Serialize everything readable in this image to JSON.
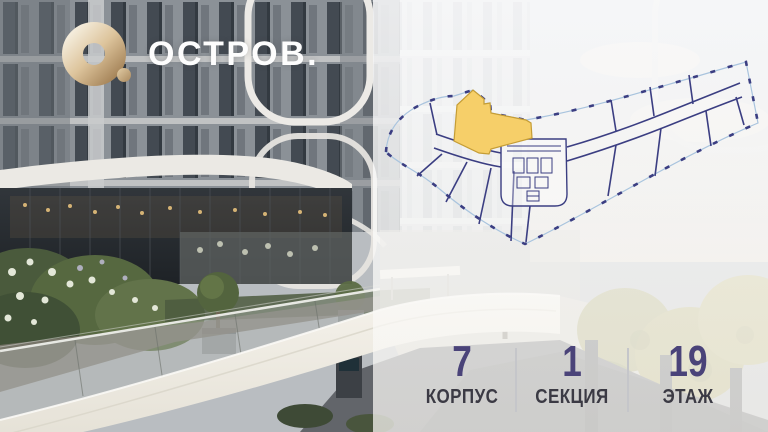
{
  "brand": {
    "logo_text": "ОСТРОВ.",
    "logo_mark": "o-ring-icon",
    "gold_light": "#f1e6d2",
    "gold_dark": "#b4946a"
  },
  "floor_plan": {
    "building_outline_color": "#3b3e82",
    "balcony_line_color": "#a9c4de",
    "highlight_fill": "#f6cf69",
    "highlight_stroke": "#c59d35"
  },
  "stats": {
    "value_color": "#4a4379",
    "label_color": "#3b3a44",
    "divider_color": "#c5c6ca",
    "items": [
      {
        "value": "7",
        "label": "КОРПУС"
      },
      {
        "value": "1",
        "label": "СЕКЦИЯ"
      },
      {
        "value": "19",
        "label": "ЭТАЖ"
      }
    ]
  }
}
